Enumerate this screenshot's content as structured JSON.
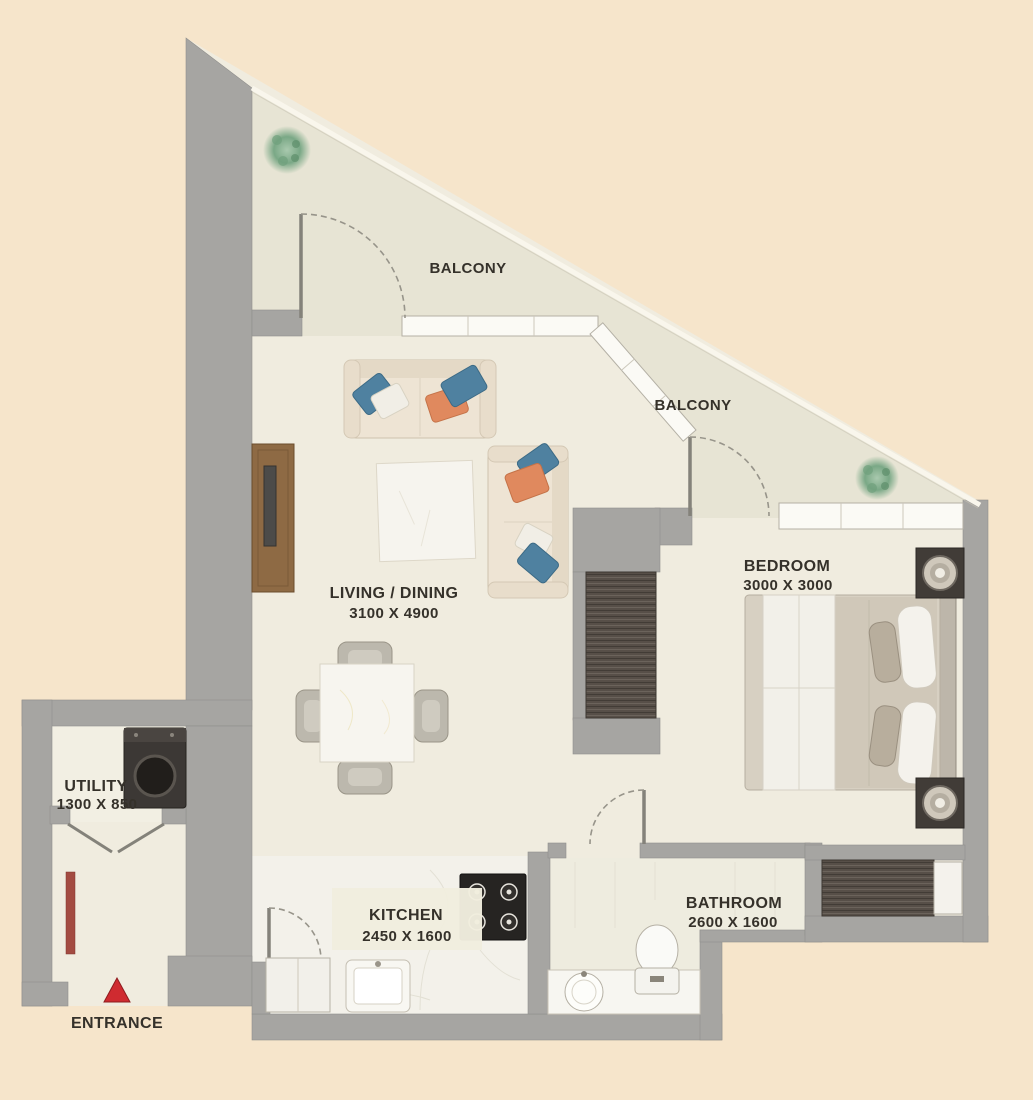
{
  "floor_plan": {
    "type": "apartment-floor-plan",
    "labels": {
      "balcony_top": "BALCONY",
      "balcony_right": "BALCONY",
      "living": {
        "name": "LIVING / DINING",
        "dims": "3100 X 4900"
      },
      "bedroom": {
        "name": "BEDROOM",
        "dims": "3000 X 3000"
      },
      "utility": {
        "name": "UTILITY",
        "dims": "1300 X 850"
      },
      "kitchen": {
        "name": "KITCHEN",
        "dims": "2450 X 1600"
      },
      "bathroom": {
        "name": "BATHROOM",
        "dims": "2600 X 1600"
      },
      "entrance": "ENTRANCE"
    },
    "colors": {
      "background": "#f6e5cb",
      "interior_floor": "#f0ecdf",
      "balcony_floor": "#e7e4d4",
      "wall": "#a6a5a2",
      "wood_tv_unit": "#8e6a44",
      "wardrobe_wood": "#574f48",
      "pillow_blue": "#4f81a0",
      "pillow_orange": "#e0895e",
      "entrance_marker": "#cf2b30",
      "plant_green": "#7aa886"
    }
  }
}
